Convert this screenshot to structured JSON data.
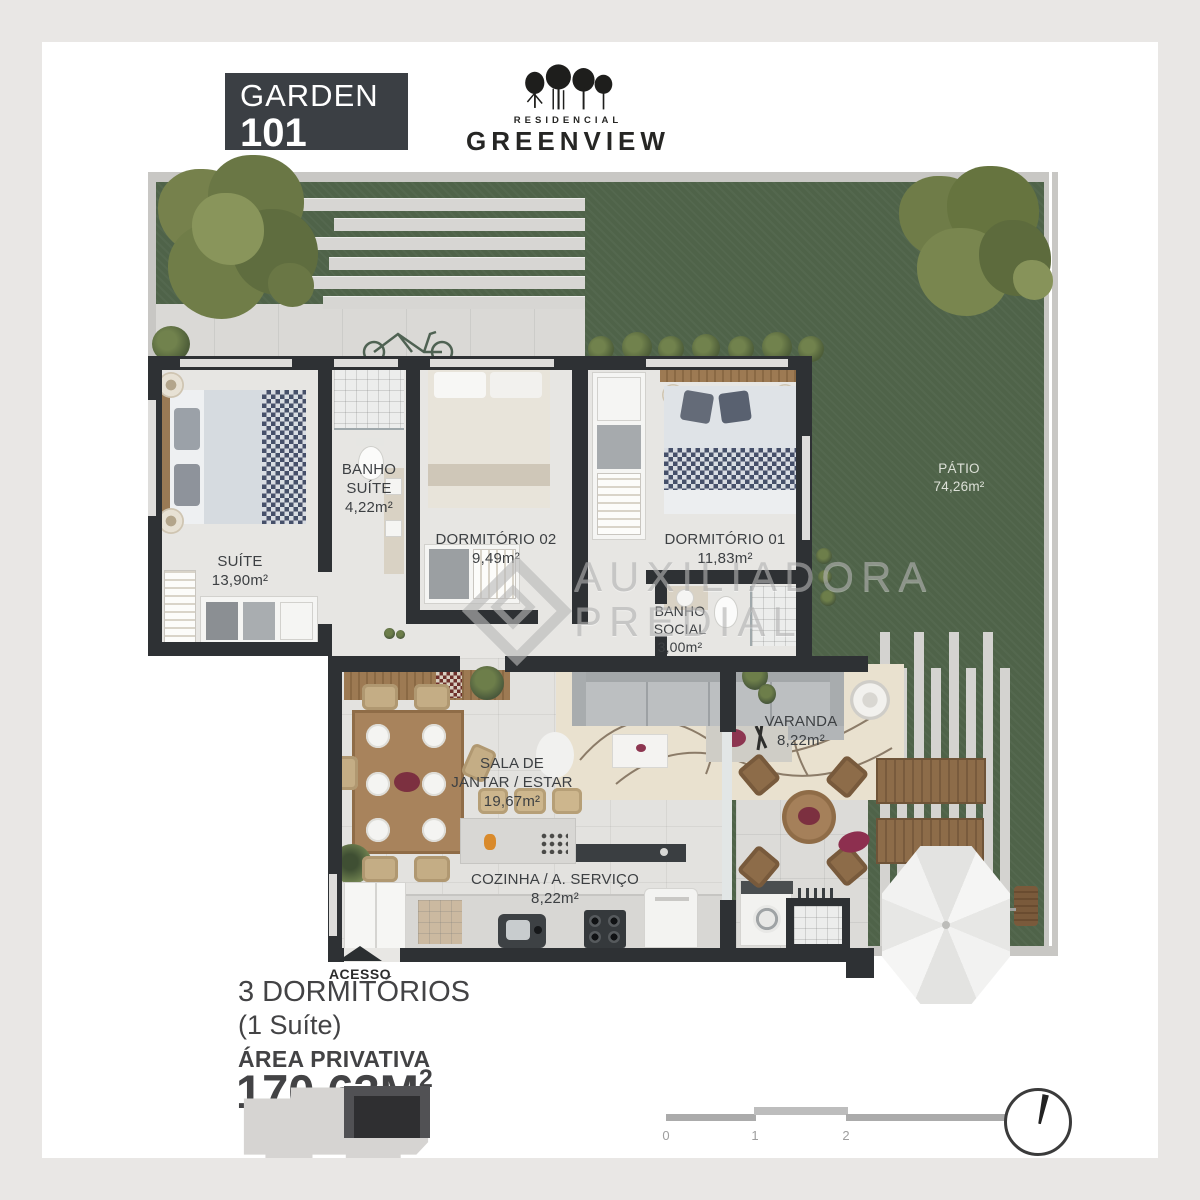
{
  "header": {
    "unit_type": "GARDEN",
    "unit_number": "101",
    "brand_top": "RESIDENCIAL",
    "brand_name": "GREENVIEW"
  },
  "plan": {
    "rooms": {
      "suite": {
        "line1": "SUÍTE",
        "area": "13,90m²"
      },
      "banho_suite": {
        "line1": "BANHO",
        "line2": "SUÍTE",
        "area": "4,22m²"
      },
      "dormitorio_02": {
        "line1": "DORMITÓRIO 02",
        "area": "9,49m²"
      },
      "dormitorio_01": {
        "line1": "DORMITÓRIO 01",
        "area": "11,83m²"
      },
      "banho_social": {
        "line1": "BANHO",
        "line2": "SOCIAL",
        "area": "3,00m²"
      },
      "sala": {
        "line1": "SALA DE",
        "line2": "JANTAR / ESTAR",
        "area": "19,67m²"
      },
      "cozinha": {
        "line1": "COZINHA / A. SERVIÇO",
        "area": "8,22m²"
      },
      "varanda": {
        "line1": "VARANDA",
        "area": "8,22m²"
      },
      "patio": {
        "line1": "PÁTIO",
        "area": "74,26m²"
      }
    },
    "access_label": "ACESSO"
  },
  "watermark": {
    "line1": "AUXILIADORA",
    "line2": "PREDIAL"
  },
  "summary": {
    "bedrooms": "3 DORMITÓRIOS",
    "suite_note": "(1 Suíte)",
    "area_label": "ÁREA PRIVATIVA",
    "area_value": "170,63M",
    "area_exponent": "2"
  },
  "scale_bar": {
    "ticks": [
      "0",
      "1",
      "2",
      "5"
    ]
  },
  "colors": {
    "badge_bg": "#3B3F44",
    "wall": "#2E3134",
    "lawn": "#4F6349",
    "floor": "#E3E2DF",
    "path": "#D7D6D3",
    "watermark": "#B9B9B9"
  }
}
